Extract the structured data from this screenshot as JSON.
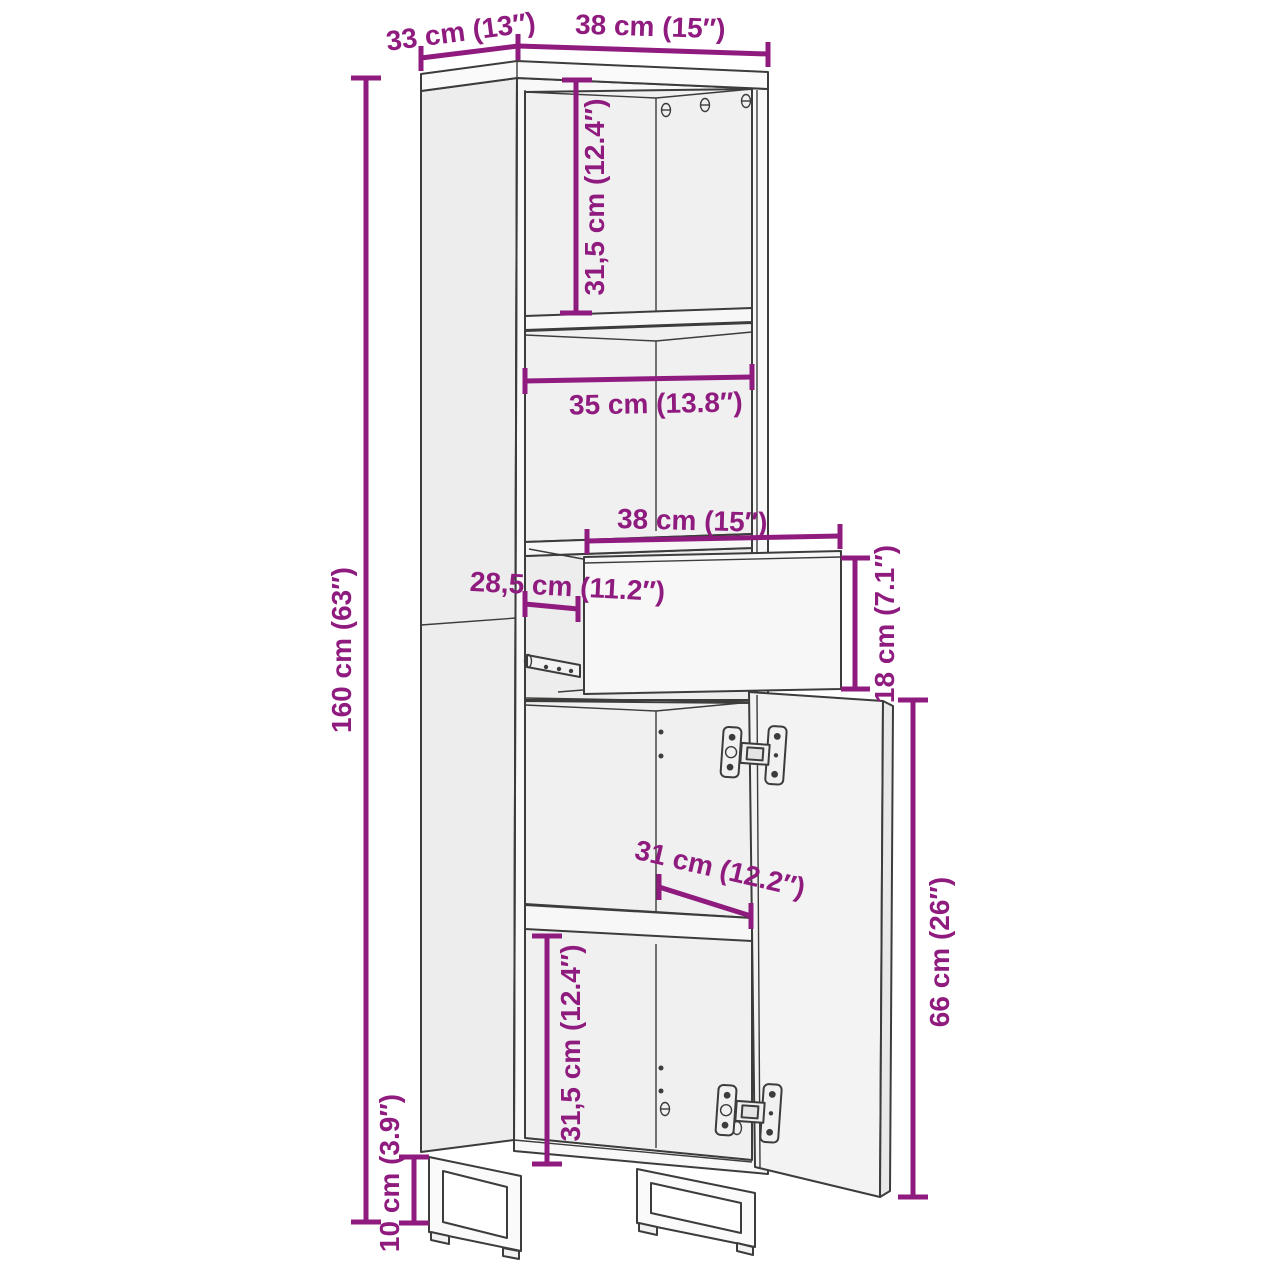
{
  "page": {
    "background": "#ffffff"
  },
  "colors": {
    "dimension_annotation": "#8F1B7F",
    "drawing_outline": "#3C3C3B"
  },
  "diagram": {
    "subject": "tall-cabinet-dimension-diagram",
    "features": [
      "open top compartments",
      "pull-out drawer",
      "open right door with hinges",
      "two U-shaped metal legs"
    ],
    "dimensions": {
      "top_depth": {
        "label": "33 cm (13″)",
        "cm": "33",
        "inches": "13"
      },
      "top_width": {
        "label": "38 cm (15″)",
        "cm": "38",
        "inches": "15"
      },
      "upper_compartment_height": {
        "label": "31,5 cm (12.4″)",
        "cm": "31,5",
        "inches": "12.4"
      },
      "middle_shelf_width": {
        "label": "35 cm (13.8″)",
        "cm": "35",
        "inches": "13.8"
      },
      "drawer_width": {
        "label": "38 cm (15″)",
        "cm": "38",
        "inches": "15"
      },
      "drawer_inner_depth": {
        "label": "28,5 cm (11.2″)",
        "cm": "28,5",
        "inches": "11.2"
      },
      "drawer_height": {
        "label": "18 cm (7.1″)",
        "cm": "18",
        "inches": "7.1"
      },
      "overall_height": {
        "label": "160 cm (63″)",
        "cm": "160",
        "inches": "63"
      },
      "lower_shelf_width": {
        "label": "31 cm (12.2″)",
        "cm": "31",
        "inches": "12.2"
      },
      "door_height": {
        "label": "66 cm (26″)",
        "cm": "66",
        "inches": "26"
      },
      "lower_compartment_height": {
        "label": "31,5 cm (12.4″)",
        "cm": "31,5",
        "inches": "12.4"
      },
      "leg_height": {
        "label": "10 cm (3.9″)",
        "cm": "10",
        "inches": "3.9"
      }
    }
  }
}
